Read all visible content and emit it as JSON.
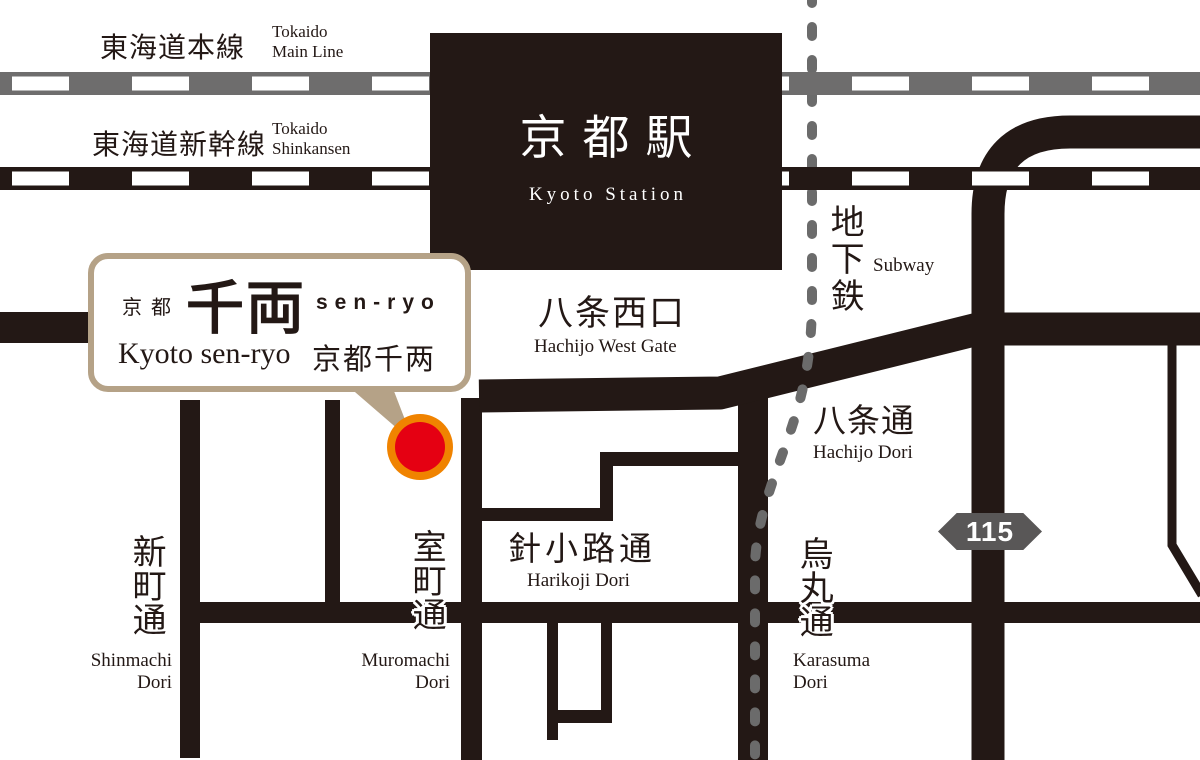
{
  "colors": {
    "ink": "#231815",
    "rail_gray": "#6e6d6d",
    "subway_gray": "#6b6b6b",
    "callout_tan": "#b5a287",
    "marker_orange": "#f08300",
    "marker_red": "#e50012",
    "badge_gray": "#595757"
  },
  "railways": {
    "main_line": {
      "jp": "東海道本線",
      "en": "Tokaido Main Line"
    },
    "shinkansen": {
      "jp": "東海道新幹線",
      "en": "Tokaido Shinkansen"
    }
  },
  "station": {
    "jp": "京都駅",
    "en": "Kyoto Station"
  },
  "subway": {
    "jp": "地下鉄",
    "en": "Subway"
  },
  "gate": {
    "jp": "八条西口",
    "en": "Hachijo West Gate"
  },
  "streets": {
    "hachijo": {
      "jp": "八条通",
      "en": "Hachijo Dori"
    },
    "karasuma": {
      "jp": "烏丸通",
      "en": "Karasuma Dori"
    },
    "shinmachi": {
      "jp": "新町通",
      "en": "Shinmachi Dori"
    },
    "muromachi": {
      "jp": "室町通",
      "en": "Muromachi Dori"
    },
    "harikoji": {
      "jp": "針小路通",
      "en": "Harikoji Dori"
    }
  },
  "route_badge": {
    "number": "115"
  },
  "callout": {
    "prefix_jp": "京都",
    "logo_jp": "千両",
    "romaji": "sen-ryo",
    "name_en": "Kyoto sen-ryo",
    "name_cn": "京都千两"
  }
}
